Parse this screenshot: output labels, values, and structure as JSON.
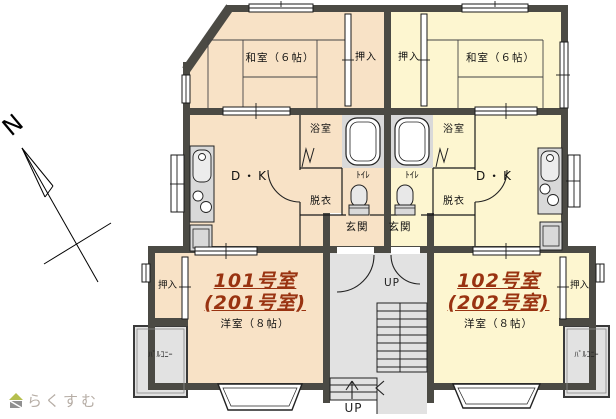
{
  "colors": {
    "unit_left_fill": "#f8e2c6",
    "unit_right_fill": "#fdf6d0",
    "wall": "#4b4a44",
    "common_gray": "#e2e2e2",
    "fixture_gray": "#d9d9d9",
    "room_title_text": "#993311",
    "logo_text": "#b6ada5"
  },
  "compass": {
    "north_label": "N"
  },
  "logo": {
    "site_name": "らくすむ"
  },
  "stairwell": {
    "up_label_entrance": "UP",
    "up_label_bottom": "UP"
  },
  "units": {
    "left": {
      "washitsu_label": "和室（６帖）",
      "oshiire_top_label": "押入",
      "dk_label": "D・K",
      "bath_label": "浴室",
      "toilet_label": "ﾄｲﾚ",
      "dressing_label": "脱衣",
      "entrance_label": "玄関",
      "room_number": "101号室",
      "room_number_alt": "(201号室)",
      "western_room_label": "洋室（８帖）",
      "oshiire_bottom_label": "押入",
      "balcony_label": "ﾊﾞﾙｺﾆｰ"
    },
    "right": {
      "washitsu_label": "和室（６帖）",
      "oshiire_top_label": "押入",
      "dk_label": "D・K",
      "bath_label": "浴室",
      "toilet_label": "ﾄｲﾚ",
      "dressing_label": "脱衣",
      "entrance_label": "玄関",
      "room_number": "102号室",
      "room_number_alt": "(202号室)",
      "western_room_label": "洋室（８帖）",
      "oshiire_bottom_label": "押入",
      "balcony_label": "ﾊﾞﾙｺﾆｰ"
    }
  }
}
